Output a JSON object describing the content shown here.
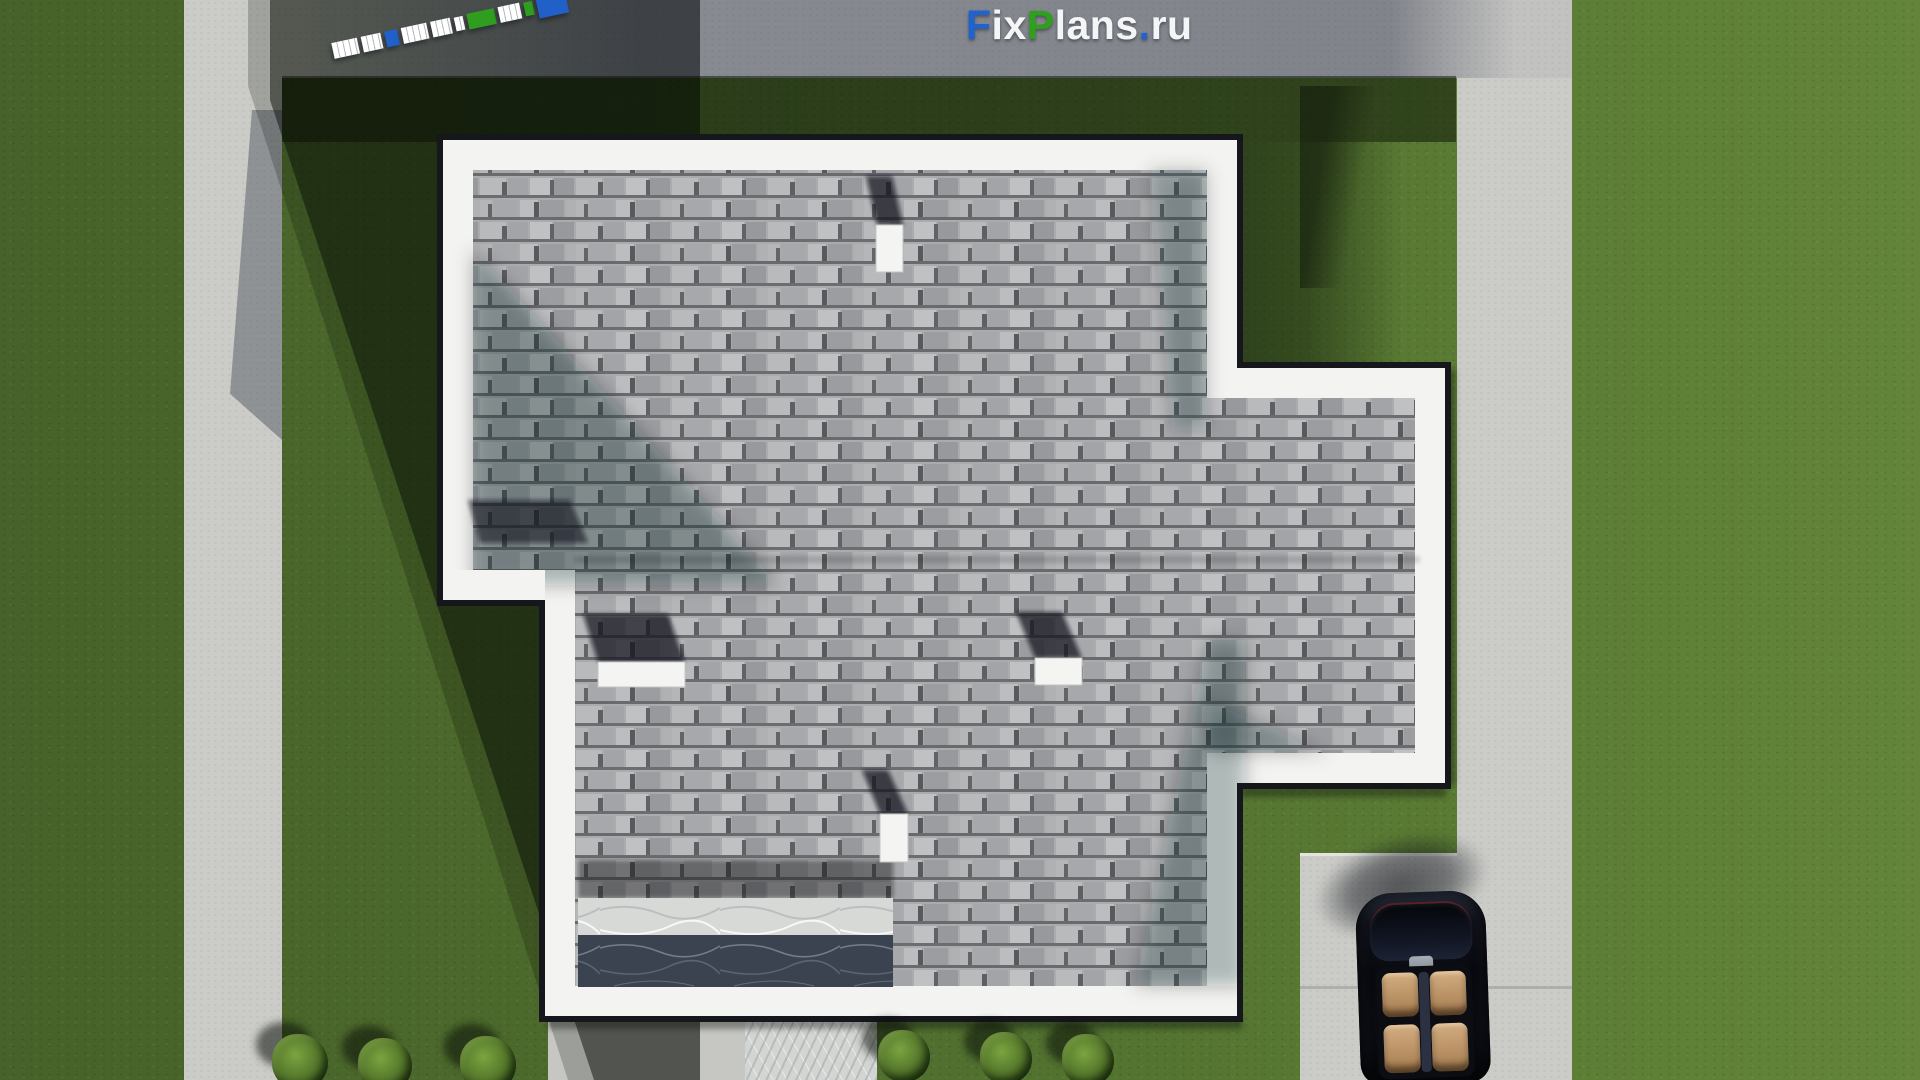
{
  "meta": {
    "description": "Top-down 3D site render of a house roof plan with lawn, roads, driveway, parked car and shrubs",
    "watermark_full_text": "FixPlans.ru"
  },
  "brand": {
    "parts": [
      {
        "text": "F",
        "color": "#1e63cf"
      },
      {
        "text": "ix",
        "color": "#f3f5f7"
      },
      {
        "text": "P",
        "color": "#2ea01c"
      },
      {
        "text": "lans",
        "color": "#f3f5f7"
      },
      {
        "text": ".",
        "color": "#1e63cf"
      },
      {
        "text": "ru",
        "color": "#f3f5f7"
      }
    ]
  },
  "scale_bar": {
    "angle_deg": -12.2,
    "segments": [
      {
        "color": "#ffffff",
        "w": 26,
        "h": 16,
        "kind": "white"
      },
      {
        "color": "#ffffff",
        "w": 20,
        "h": 16,
        "kind": "white"
      },
      {
        "color": "#2160c8",
        "w": 13,
        "h": 16,
        "kind": "blue"
      },
      {
        "color": "#ffffff",
        "w": 26,
        "h": 16,
        "kind": "white"
      },
      {
        "color": "#ffffff",
        "w": 20,
        "h": 16,
        "kind": "white"
      },
      {
        "color": "#ffffff",
        "w": 9,
        "h": 14,
        "kind": "white"
      },
      {
        "color": "#2f9e1f",
        "w": 28,
        "h": 16,
        "kind": "green"
      },
      {
        "color": "#ffffff",
        "w": 22,
        "h": 16,
        "kind": "white"
      },
      {
        "color": "#2f9e1f",
        "w": 9,
        "h": 14,
        "kind": "green"
      },
      {
        "color": "#2160c8",
        "w": 30,
        "h": 24,
        "kind": "blue"
      }
    ]
  },
  "site": {
    "grass_lit": "#5b7c34",
    "grass_shadow": "#24371b",
    "road": "#cbccc8",
    "road_shadow_tint": "#1a1f36",
    "concrete_patio": "#c6c7c3",
    "walkway_marble": "#d3d5d2"
  },
  "roof": {
    "shingle_color": "#a9abad",
    "border_color": "#f3f4f2",
    "edge_color": "#15171c",
    "chimney_color": "#f4f5f3",
    "chimney_count": 4,
    "terrace_marble_light": "#d7d9d6",
    "terrace_marble_dark": "#3c4350"
  },
  "vehicle": {
    "kind": "car-top-view",
    "body_color": "#0c0f16",
    "seat_color": "#c9a274",
    "seat_count": 4
  },
  "bushes": {
    "foliage_color": "#4a6b25",
    "items": [
      {
        "x": 300,
        "y": 1034,
        "s": 56
      },
      {
        "x": 385,
        "y": 1038,
        "s": 54
      },
      {
        "x": 488,
        "y": 1036,
        "s": 56
      },
      {
        "x": 904,
        "y": 1030,
        "s": 52
      },
      {
        "x": 1006,
        "y": 1032,
        "s": 52
      },
      {
        "x": 1088,
        "y": 1034,
        "s": 52
      }
    ]
  }
}
